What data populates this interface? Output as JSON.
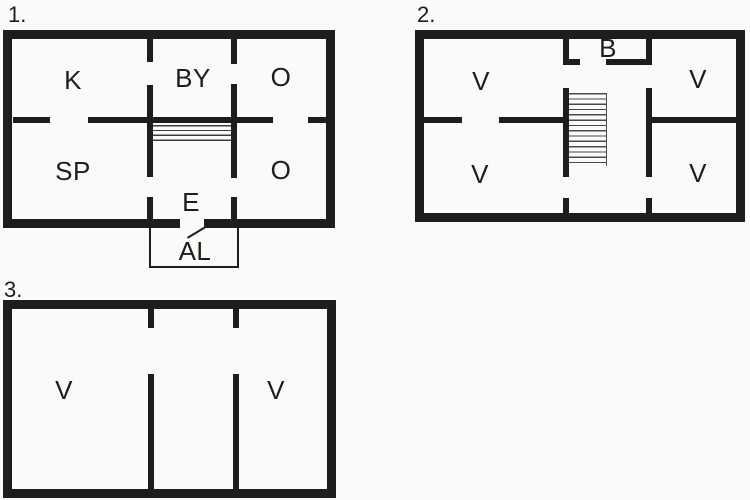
{
  "title": "Three-storey floor plan diagram",
  "colors": {
    "background": "#fbfaf8",
    "wall": "#1d1d1b",
    "stair_tread": "#4a4a48"
  },
  "plans": [
    {
      "number": "1.",
      "rooms": [
        {
          "id": "k",
          "label": "K"
        },
        {
          "id": "by",
          "label": "BY"
        },
        {
          "id": "o-upper",
          "label": "O"
        },
        {
          "id": "sp",
          "label": "SP"
        },
        {
          "id": "o-lower",
          "label": "O"
        },
        {
          "id": "e",
          "label": "E"
        },
        {
          "id": "al",
          "label": "AL"
        }
      ]
    },
    {
      "number": "2.",
      "rooms": [
        {
          "id": "b",
          "label": "B"
        },
        {
          "id": "v-top-left",
          "label": "V"
        },
        {
          "id": "v-top-right",
          "label": "V"
        },
        {
          "id": "v-bottom-left",
          "label": "V"
        },
        {
          "id": "v-bottom-right",
          "label": "V"
        }
      ]
    },
    {
      "number": "3.",
      "rooms": [
        {
          "id": "v-left",
          "label": "V"
        },
        {
          "id": "v-right",
          "label": "V"
        }
      ]
    }
  ]
}
